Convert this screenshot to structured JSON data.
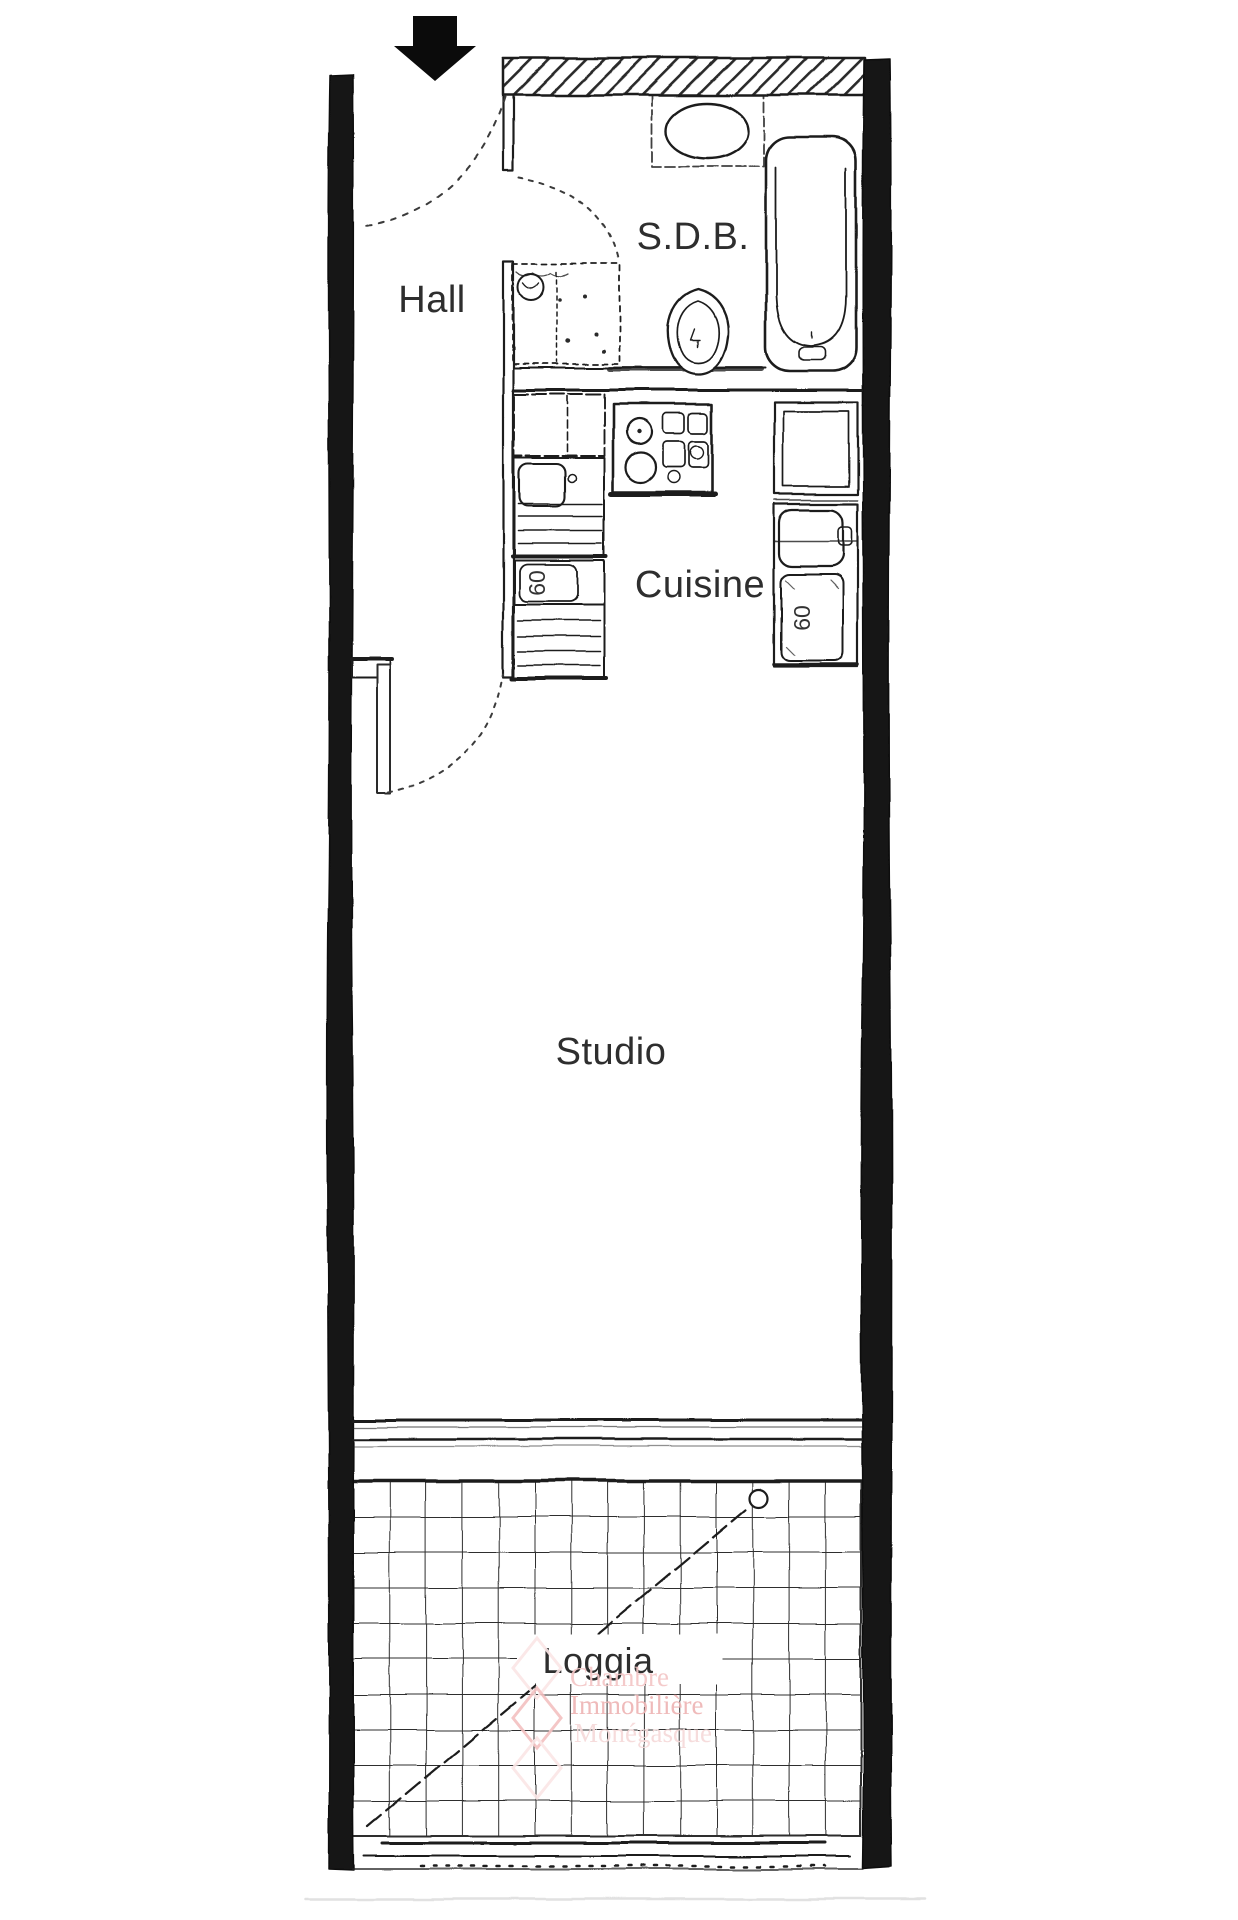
{
  "plan": {
    "type": "apartment-floor-plan",
    "rooms": [
      {
        "id": "hall",
        "label": "Hall"
      },
      {
        "id": "sdb",
        "label": "S.D.B."
      },
      {
        "id": "cuisine",
        "label": "Cuisine"
      },
      {
        "id": "studio",
        "label": "Studio"
      },
      {
        "id": "loggia",
        "label": "Loggia"
      }
    ],
    "dimension_labels": {
      "kitchen_left_unit": "60",
      "kitchen_right_unit": "60"
    },
    "entrance": {
      "symbol": "down-arrow"
    },
    "colors": {
      "ink": "#1f1f1f",
      "wall_fill": "#141414",
      "label": "#2e2e2e"
    }
  },
  "watermark": {
    "logo": "stacked-diamonds",
    "lines": [
      "Chambre",
      "Immobilière",
      "Monégasque"
    ],
    "colors": {
      "line1": "#f3c6c6",
      "line2": "#eeb5b5",
      "line3": "#f6dada"
    }
  }
}
